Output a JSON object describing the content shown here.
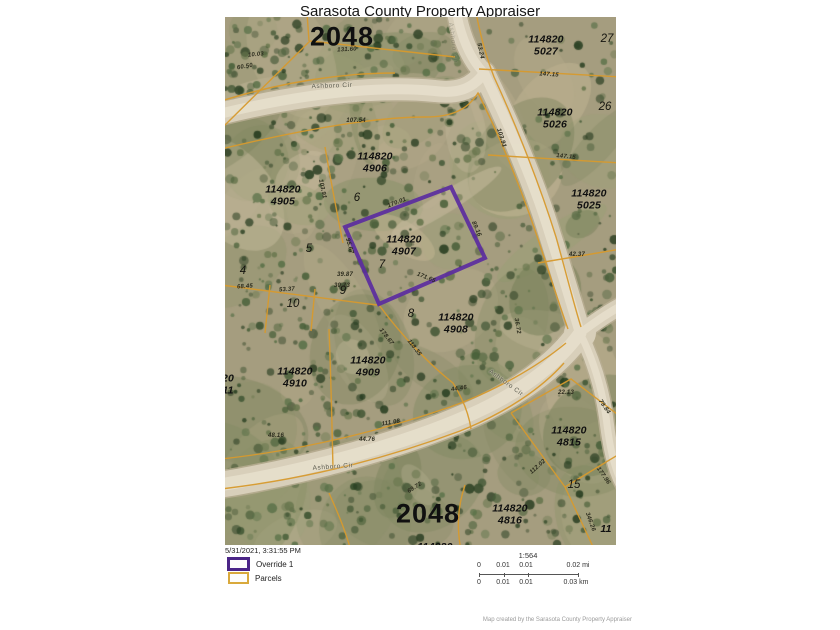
{
  "title": "Sarasota County Property Appraiser",
  "colors": {
    "override_purple": "#5b2da0",
    "parcel_line_orange": "#d79a2e",
    "road_tan": "#d8cfba",
    "terrain_base": "#a59d7f"
  },
  "map": {
    "section_labels": [
      {
        "text": "2048",
        "x": 117,
        "y": 20
      },
      {
        "text": "2048",
        "x": 203,
        "y": 497
      }
    ],
    "parcel_labels": [
      {
        "text": "114820\n5027",
        "x": 321,
        "y": 29
      },
      {
        "text": "114820\n5026",
        "x": 330,
        "y": 102
      },
      {
        "text": "114820\n5025",
        "x": 364,
        "y": 183
      },
      {
        "text": "114820\n4906",
        "x": 150,
        "y": 146
      },
      {
        "text": "114820\n4905",
        "x": 58,
        "y": 179
      },
      {
        "text": "114820\n4907",
        "x": 179,
        "y": 229
      },
      {
        "text": "114820\n4908",
        "x": 231,
        "y": 307
      },
      {
        "text": "114820\n4909",
        "x": 143,
        "y": 350
      },
      {
        "text": "114820\n4910",
        "x": 70,
        "y": 361
      },
      {
        "text": "114820\n4815",
        "x": 344,
        "y": 420
      },
      {
        "text": "114820\n4816",
        "x": 285,
        "y": 498
      },
      {
        "text": "20\n11",
        "x": 3,
        "y": 368
      },
      {
        "text": "114820",
        "x": 210,
        "y": 531
      },
      {
        "text": "11",
        "x": 381,
        "y": 513
      }
    ],
    "lot_numbers": [
      {
        "text": "27",
        "x": 382,
        "y": 22
      },
      {
        "text": "26",
        "x": 380,
        "y": 90
      },
      {
        "text": "6",
        "x": 132,
        "y": 181
      },
      {
        "text": "5",
        "x": 84,
        "y": 232
      },
      {
        "text": "4",
        "x": 18,
        "y": 254
      },
      {
        "text": "7",
        "x": 157,
        "y": 248
      },
      {
        "text": "9",
        "x": 118,
        "y": 274
      },
      {
        "text": "10",
        "x": 68,
        "y": 287
      },
      {
        "text": "8",
        "x": 186,
        "y": 297
      },
      {
        "text": "15",
        "x": 349,
        "y": 468
      }
    ],
    "dimension_labels": [
      {
        "text": "10.03",
        "x": 31,
        "y": 38,
        "rot": -5
      },
      {
        "text": "60.50",
        "x": 20,
        "y": 50,
        "rot": -10
      },
      {
        "text": "131.60",
        "x": 122,
        "y": 33,
        "rot": -3
      },
      {
        "text": "107.54",
        "x": 131,
        "y": 104,
        "rot": 0
      },
      {
        "text": "147.15",
        "x": 324,
        "y": 58,
        "rot": 4
      },
      {
        "text": "147.15",
        "x": 341,
        "y": 140,
        "rot": 6
      },
      {
        "text": "103.91",
        "x": 276,
        "y": 121,
        "rot": 72
      },
      {
        "text": "53.24",
        "x": 255,
        "y": 34,
        "rot": 78
      },
      {
        "text": "42.37",
        "x": 352,
        "y": 238,
        "rot": 0
      },
      {
        "text": "170.01",
        "x": 172,
        "y": 186,
        "rot": -21
      },
      {
        "text": "89.16",
        "x": 251,
        "y": 212,
        "rot": 66
      },
      {
        "text": "171.65",
        "x": 201,
        "y": 261,
        "rot": 22
      },
      {
        "text": "95.67",
        "x": 124,
        "y": 229,
        "rot": 74
      },
      {
        "text": "103.91",
        "x": 97,
        "y": 172,
        "rot": 78
      },
      {
        "text": "68.45",
        "x": 20,
        "y": 270,
        "rot": -4
      },
      {
        "text": "53.37",
        "x": 62,
        "y": 273,
        "rot": -4
      },
      {
        "text": "39.87",
        "x": 120,
        "y": 258,
        "rot": 0
      },
      {
        "text": "30.73",
        "x": 117,
        "y": 269,
        "rot": 0
      },
      {
        "text": "36.72",
        "x": 292,
        "y": 309,
        "rot": 80
      },
      {
        "text": "178.67",
        "x": 161,
        "y": 320,
        "rot": 52
      },
      {
        "text": "118.35",
        "x": 189,
        "y": 331,
        "rot": 52
      },
      {
        "text": "111.08",
        "x": 166,
        "y": 406,
        "rot": -10
      },
      {
        "text": "48.16",
        "x": 51,
        "y": 419,
        "rot": 0
      },
      {
        "text": "44.76",
        "x": 142,
        "y": 423,
        "rot": 0
      },
      {
        "text": "44.46",
        "x": 234,
        "y": 372,
        "rot": -8
      },
      {
        "text": "69.72",
        "x": 190,
        "y": 471,
        "rot": -33
      },
      {
        "text": "22.13",
        "x": 341,
        "y": 376,
        "rot": 0
      },
      {
        "text": "79.84",
        "x": 379,
        "y": 390,
        "rot": 55
      },
      {
        "text": "112.02",
        "x": 313,
        "y": 450,
        "rot": -42
      },
      {
        "text": "177.96",
        "x": 378,
        "y": 459,
        "rot": 55
      },
      {
        "text": "346.26",
        "x": 365,
        "y": 505,
        "rot": 70
      }
    ],
    "road_labels": [
      {
        "text": "Ashboro Cir",
        "x": 107,
        "y": 69,
        "rot": -2
      },
      {
        "text": "Ashboro Cir",
        "x": 108,
        "y": 450,
        "rot": -4
      },
      {
        "text": "Ashboro Cir",
        "x": 281,
        "y": 366,
        "rot": 36
      },
      {
        "text": "Ashboro Cir",
        "x": 228,
        "y": 26,
        "rot": 83,
        "opacity": 0.35
      }
    ]
  },
  "legend": {
    "timestamp": "5/31/2021, 3:31:55 PM",
    "items": [
      {
        "label": "Override 1",
        "color": "#4b2587"
      },
      {
        "label": "Parcels",
        "color": "#d9a93c"
      }
    ]
  },
  "scale": {
    "ratio": "1:564",
    "mi_ticks": [
      "0",
      "0.01",
      "0.01",
      "0.02 mi"
    ],
    "km_ticks": [
      "0",
      "0.01",
      "0.01",
      "0.03 km"
    ]
  },
  "attribution": "Map created by the Sarasota County Property Appraiser"
}
